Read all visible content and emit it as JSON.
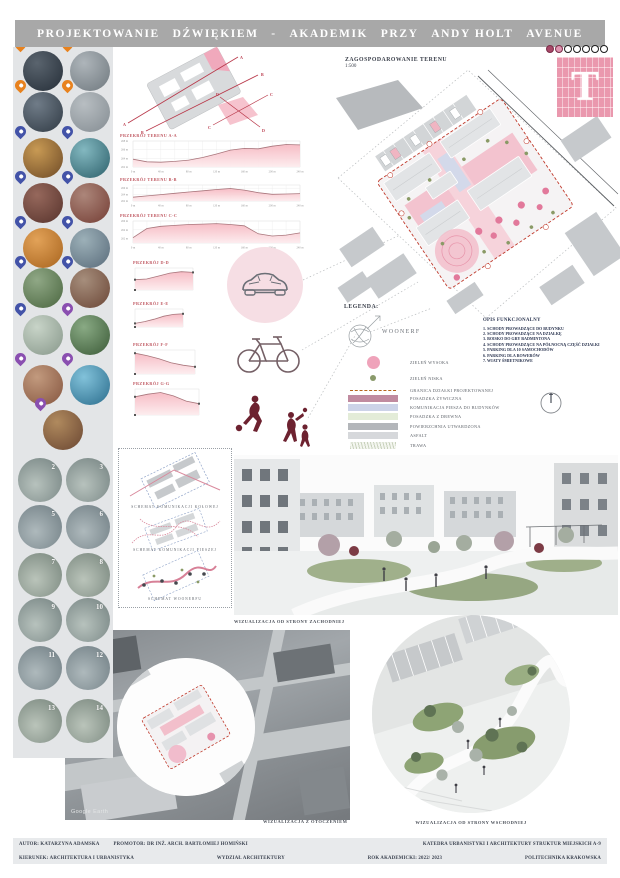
{
  "header": {
    "words": [
      "PROJEKTOWANIE",
      "DŹWIĘKIEM",
      "-",
      "AKADEMIK",
      "PRZY",
      "ANDY HOLT",
      "AVENUE"
    ]
  },
  "logo": {
    "letter": "T",
    "dots_total": 7,
    "dots_filled": 2,
    "fill_colors": [
      "#a84868",
      "#e096b2"
    ],
    "brick_color": "#f4a8ba"
  },
  "sidebar": {
    "photo_rows": [
      {
        "pin_left": "#e8821e",
        "pin_right": "#e8821e",
        "left": [
          "#252e38",
          "#5a646e"
        ],
        "right": [
          "#6f787e",
          "#aeb5ba"
        ]
      },
      {
        "pin_left": "#e8821e",
        "pin_right": "#e8821e",
        "left": [
          "#303a44",
          "#707c88"
        ],
        "right": [
          "#848c92",
          "#b8bec2"
        ]
      },
      {
        "pin_left": "#4353a8",
        "pin_right": "#4353a8",
        "left": [
          "#6e4a26",
          "#c89a54"
        ],
        "right": [
          "#2c5f6a",
          "#83b8c0"
        ]
      },
      {
        "pin_left": "#4353a8",
        "pin_right": "#4353a8",
        "left": [
          "#57332c",
          "#96685c"
        ],
        "right": [
          "#743d34",
          "#ac867a"
        ]
      },
      {
        "pin_left": "#4353a8",
        "pin_right": "#4353a8",
        "left": [
          "#a8641e",
          "#e2a258"
        ],
        "right": [
          "#596b7a",
          "#9cb0b8"
        ]
      },
      {
        "pin_left": "#4353a8",
        "pin_right": "#4353a8",
        "left": [
          "#4a663f",
          "#90a886"
        ],
        "right": [
          "#6b4636",
          "#a68e7c"
        ]
      },
      {
        "pin_left": "#4353a8",
        "pin_right": "#8a4fb0",
        "left": [
          "#87978a",
          "#c8d4c8"
        ],
        "right": [
          "#3b5a37",
          "#89aa84"
        ]
      },
      {
        "pin_left": "#8a4fb0",
        "pin_right": "#8a4fb0",
        "left": [
          "#85553f",
          "#c29a7e"
        ],
        "right": [
          "#2a6c8c",
          "#82c2da"
        ]
      },
      {
        "pin_left": "#8a4fb0",
        "pin_right": null,
        "left": [
          "#6a4632",
          "#b08a5e"
        ],
        "right": null
      }
    ],
    "numbered_circles": [
      "2",
      "3",
      "5",
      "6",
      "7",
      "8",
      "9",
      "10",
      "11",
      "12",
      "13",
      "14"
    ]
  },
  "sketch": {
    "labels": [
      "A",
      "A",
      "B",
      "B",
      "C",
      "C",
      "D",
      "D"
    ]
  },
  "siteplan": {
    "title": "ZAGOSPODAROWANIE TERENU",
    "scale": "1:500"
  },
  "legend": {
    "heading": "LEGENDA:",
    "woonerf_label": "WOONERF",
    "items": [
      {
        "type": "circle",
        "color": "#efa3ba",
        "label": "ZIELEŃ WYSOKA"
      },
      {
        "type": "dot",
        "color": "#8a9a6b",
        "label": "ZIELEŃ NISKA"
      },
      {
        "type": "dash",
        "color": "#b5651d",
        "label": "GRANICA DZIAŁKI PROJEKTOWANEJ"
      },
      {
        "type": "rect",
        "color": "#c08ba0",
        "label": "POSADZKA ŻYWICZNA"
      },
      {
        "type": "rect",
        "color": "#ccd3e8",
        "label": "KOMUNIKACJA PIESZA DO BUDYNKÓW"
      },
      {
        "type": "rect",
        "color": "#e3ecd8",
        "label": "POSADZKA Z DREWNA"
      },
      {
        "type": "rect",
        "color": "#b3b6ba",
        "label": "POWIERZCHNIA UTWARDZONA"
      },
      {
        "type": "rect",
        "color": "#d6d8db",
        "label": "ASFALT"
      },
      {
        "type": "sketch",
        "color": "#c9d2bd",
        "label": "TRAWA"
      }
    ]
  },
  "functional": {
    "heading": "OPIS FUNKCJONALNY",
    "items": [
      "1. SCHODY PROWADZĄCE DO BUDYNKU",
      "2. SCHODY PROWADZĄCE NA DZIAŁKĘ",
      "3. BOISKO DO GRY BADMINTONA",
      "4. SCHODY PROWADZĄCE NA PÓŁNOCNĄ CZĘŚĆ DZIAŁKI",
      "5. PARKING DLA 10 SAMOCHODÓW",
      "6. PARKING DLA ROWERÓW",
      "7. WIATY ŚMIETNIKOWE"
    ]
  },
  "diagrams": {
    "captions": [
      "SCHEMAT KOMUNIKACJI KOŁOWEJ",
      "SCHEMAT KOMUNIKACJI PIESZEJ",
      "SCHEMAT WOONERFU"
    ]
  },
  "visualizations": {
    "main_caption": "WIZUALIZACJA OD STRONY ZACHODNIEJ",
    "context_caption": "WIZUALIZACJA Z OTOCZENIEM",
    "east_caption": "WIZUALIZACJA OD STRONY WSCHODNIEJ",
    "watermark": "Google Earth"
  },
  "footer": {
    "author": "AUTOR: KATARZYNA ADAMSKA",
    "promoter": "PROMOTOR: DR INŻ. ARCH. BARTŁOMIEJ HOMIŃSKI",
    "department": "KATEDRA URBANISTYKI I ARCHITEKTURY STRUKTUR MIEJSKICH A-9",
    "field": "KIERUNEK: ARCHITEKTURA I URBANISTYKA",
    "faculty": "WYDZIAŁ ARCHITEKTURY",
    "year": "ROK AKADEMICKI: 2022/ 2023",
    "university": "POLITECHNIKA KRAKOWSKA"
  },
  "chart_data": [
    {
      "id": "A",
      "type": "area",
      "title": "PRZEKRÓJ TERENU A-A",
      "size": "large",
      "x": [
        0,
        20,
        40,
        60,
        80,
        100,
        120,
        140,
        160,
        180,
        200,
        220,
        240
      ],
      "values": [
        263.8,
        263.2,
        263.1,
        263.3,
        263.6,
        264.2,
        265.0,
        265.9,
        266.3,
        266.2,
        266.8,
        267.2,
        267.1
      ],
      "ylim": [
        262,
        268
      ],
      "yticks": [
        262,
        264,
        266,
        268
      ],
      "unit": "m"
    },
    {
      "id": "B",
      "type": "area",
      "title": "PRZEKRÓJ TERENU B-B",
      "size": "large",
      "x": [
        0,
        20,
        40,
        60,
        80,
        100,
        120,
        140,
        160,
        180,
        200,
        220,
        240
      ],
      "values": [
        263.2,
        263.6,
        264.0,
        264.4,
        264.8,
        265.2,
        265.6,
        265.9,
        265.4,
        264.6,
        264.1,
        264.2,
        264.3
      ],
      "ylim": [
        262,
        267
      ],
      "yticks": [
        262,
        264,
        266
      ],
      "unit": "m"
    },
    {
      "id": "C",
      "type": "area",
      "title": "PRZEKRÓJ TERENU C-C",
      "size": "large",
      "x": [
        0,
        20,
        40,
        60,
        80,
        100,
        120,
        140,
        160,
        180,
        200,
        220,
        240
      ],
      "values": [
        262.2,
        264.3,
        264.8,
        265.0,
        265.2,
        265.3,
        265.4,
        265.2,
        264.9,
        263.1,
        262.6,
        262.8,
        263.3
      ],
      "ylim": [
        261,
        266
      ],
      "yticks": [
        262,
        264,
        266
      ],
      "unit": "m"
    },
    {
      "id": "D",
      "type": "area",
      "title": "PRZEKRÓJ D-D",
      "size": "small",
      "x": [
        0,
        10,
        20,
        30,
        40,
        50
      ],
      "values": [
        265.4,
        265.5,
        265.9,
        266.3,
        266.5,
        266.4
      ],
      "ylim": [
        264,
        267
      ],
      "yticks": [],
      "unit": "m"
    },
    {
      "id": "E",
      "type": "area",
      "title": "PRZEKRÓJ E-E",
      "size": "small",
      "x": [
        0,
        10,
        20,
        30,
        40,
        50
      ],
      "values": [
        264.6,
        264.9,
        265.3,
        265.8,
        266.1,
        266.2
      ],
      "ylim": [
        264,
        267
      ],
      "yticks": [],
      "unit": "m"
    },
    {
      "id": "F",
      "type": "area",
      "title": "PRZEKRÓJ F-F",
      "size": "small",
      "x": [
        0,
        10,
        20,
        30,
        40,
        50
      ],
      "values": [
        266.6,
        266.3,
        265.9,
        265.4,
        265.1,
        264.9
      ],
      "ylim": [
        264,
        267
      ],
      "yticks": [],
      "unit": "m"
    },
    {
      "id": "G",
      "type": "area",
      "title": "PRZEKRÓJ G-G",
      "size": "small",
      "x": [
        0,
        10,
        20,
        30,
        40,
        50
      ],
      "values": [
        266.1,
        266.4,
        266.6,
        266.2,
        265.6,
        265.3
      ],
      "ylim": [
        264,
        267
      ],
      "yticks": [],
      "unit": "m"
    }
  ]
}
